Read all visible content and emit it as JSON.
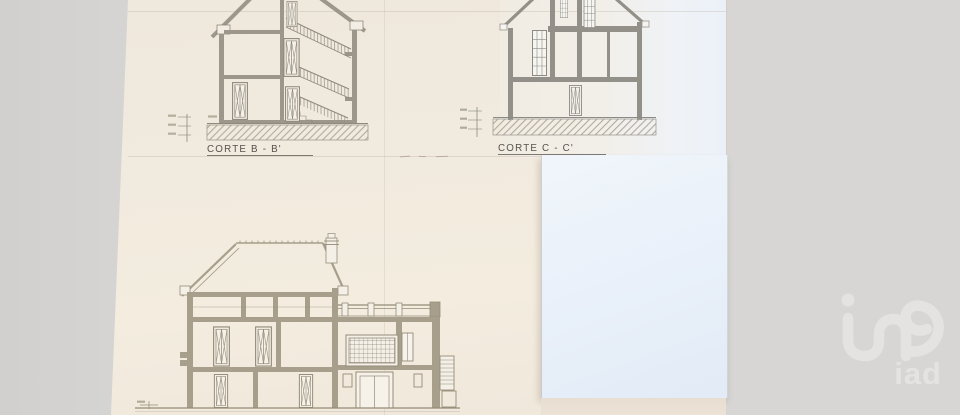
{
  "photo": {
    "subject": "Architectural cross-section drawings on overlapping paper sheets"
  },
  "drawings": {
    "corte_b": {
      "label": "CORTE B - B'"
    },
    "corte_c": {
      "label": "CORTE C - C'"
    }
  },
  "watermark": {
    "text": "iad"
  },
  "colors": {
    "background_gray": "#d6d5d3",
    "paper_cream": "#f0e9dd",
    "paper_white": "#ecf1f8",
    "ink_warm": "#8f887b",
    "ink_cool": "#8b8a86",
    "wall_fill_warm": "#9d968a",
    "wall_fill_big": "#a79e8b",
    "label_ink": "#56524b",
    "watermark_gray": "#e4e3e1"
  }
}
